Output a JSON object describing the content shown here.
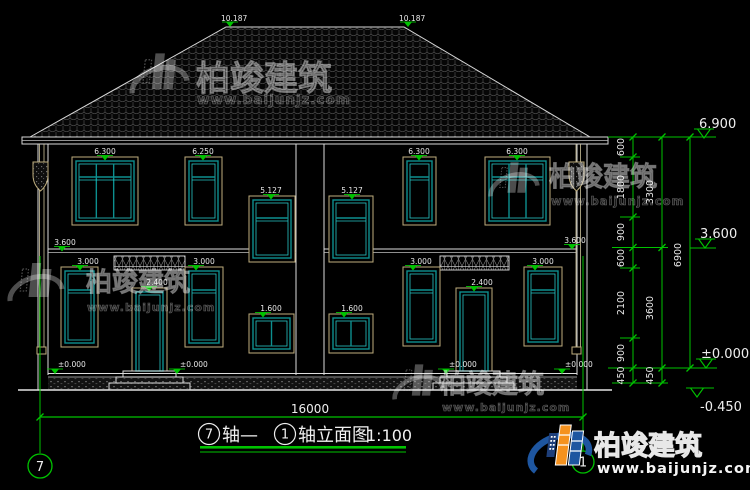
{
  "drawing_title": {
    "full": "⑦轴—①轴立面图 1:100",
    "axis_from_num": "7",
    "seg_mid": "轴—",
    "axis_to_num": "1",
    "seg_tail": "轴立面图",
    "scale": "1:100"
  },
  "axis_bubbles": {
    "left": "7",
    "right": "1"
  },
  "overall_dim": "16000",
  "ridge_marks": [
    "10.187",
    "10.187"
  ],
  "labels": {
    "f2": [
      "6.300",
      "6.250",
      "5.127",
      "5.127",
      "6.300",
      "6.300"
    ],
    "mid": [
      "3.600",
      "3.600"
    ],
    "f1": [
      "3.000",
      "3.000",
      "3.000",
      "3.000"
    ],
    "door": [
      "2.400",
      "2.400"
    ],
    "small": [
      "1.600",
      "1.600"
    ],
    "zero": [
      "±0.000",
      "±0.000",
      "±0.000",
      "±0.000"
    ]
  },
  "right_levels": [
    "6.900",
    "3.600",
    "±0.000",
    "-0.450"
  ],
  "dims": {
    "inner": [
      "600",
      "1800",
      "900",
      "600",
      "2100",
      "900",
      "450"
    ],
    "middle": [
      "3300",
      "3600",
      "450"
    ],
    "outer": [
      "6900"
    ]
  },
  "watermark": {
    "brand": "柏竣建筑",
    "url": "www.baijunjz.com"
  },
  "footer_brand": {
    "brand": "柏竣建筑",
    "url": "www.baijunjz.com"
  },
  "colors": {
    "annotation_green": "#00c300",
    "frame_teal": "#0d8f8f",
    "frame_tan": "#bfae7e",
    "line_white": "#dcdcdc",
    "brand_blue": "#1e56a0",
    "brand_orange": "#f5921e"
  }
}
